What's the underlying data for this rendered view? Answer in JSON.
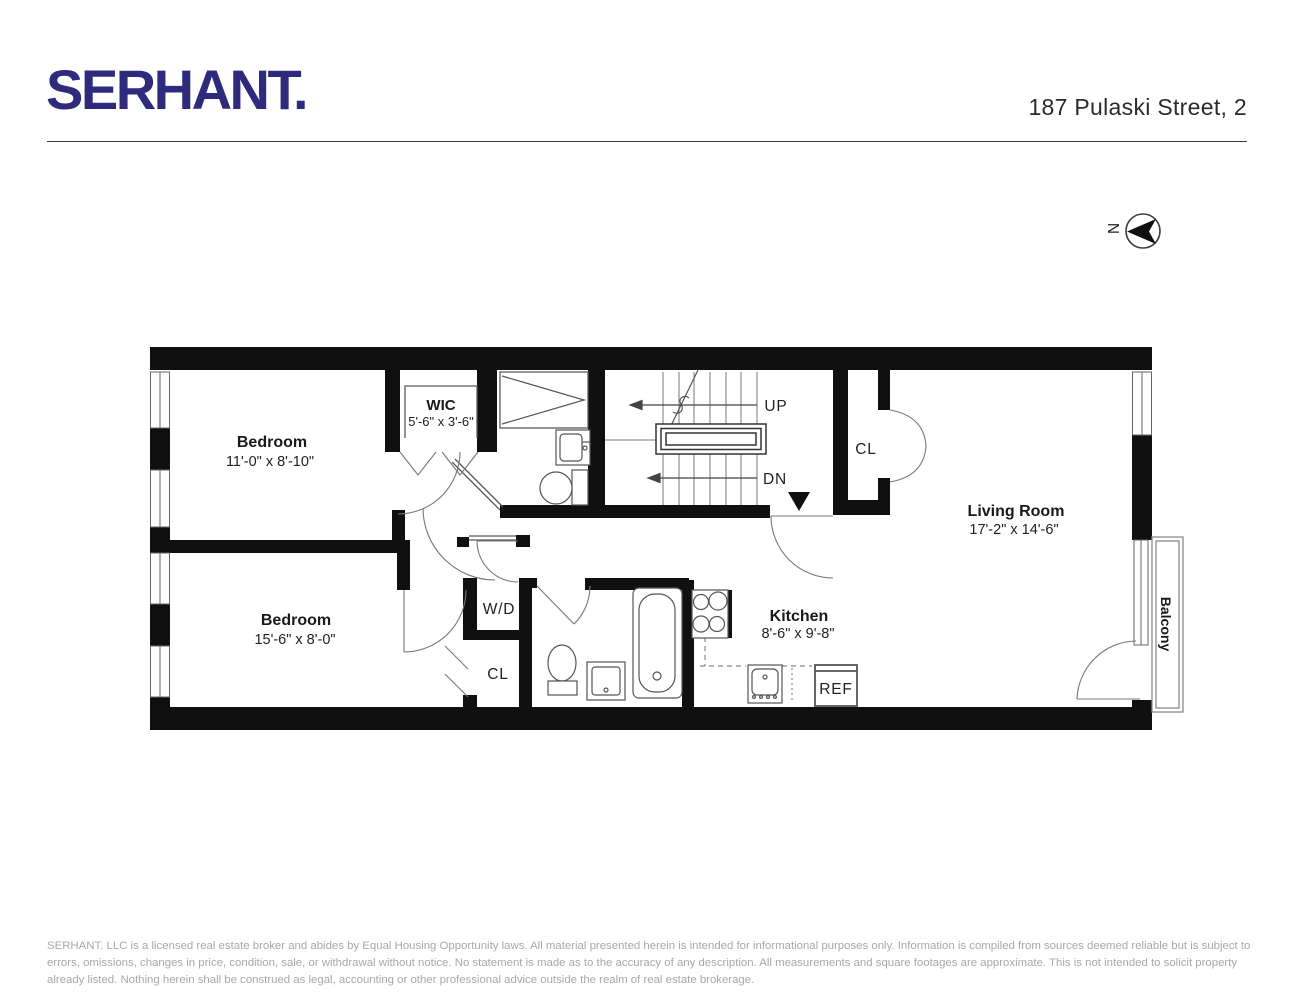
{
  "header": {
    "logo": "SERHANT.",
    "address": "187 Pulaski Street, 2"
  },
  "compass": {
    "north_label": "N"
  },
  "floorplan": {
    "rooms": {
      "bedroom1": {
        "name": "Bedroom",
        "dims": "11'-0\" x 8'-10\""
      },
      "wic": {
        "name": "WIC",
        "dims": "5'-6\" x 3'-6\""
      },
      "bedroom2": {
        "name": "Bedroom",
        "dims": "15'-6\" x 8'-0\""
      },
      "kitchen": {
        "name": "Kitchen",
        "dims": "8'-6\" x 9'-8\""
      },
      "living_room": {
        "name": "Living Room",
        "dims": "17'-2\" x 14'-6\""
      },
      "balcony": {
        "name": "Balcony"
      },
      "closet_hall": {
        "name": "CL"
      },
      "closet_lower": {
        "name": "CL"
      },
      "washer_dryer": {
        "name": "W/D"
      },
      "refrigerator": {
        "name": "REF"
      }
    },
    "stairs": {
      "up": "UP",
      "down": "DN"
    }
  },
  "footer": {
    "disclaimer": "SERHANT. LLC is a licensed real estate broker and abides by Equal Housing Opportunity laws. All material presented herein is intended for informational purposes only. Information is compiled from sources deemed  reliable but is subject to errors, omissions, changes in price, condition, sale, or withdrawal without notice. No statement is made as to the accuracy of any description. All measurements and square footages are approximate. This is not intended to solicit property already listed. Nothing herein shall be construed as legal, accounting or other professional advice outside the realm of real estate brokerage."
  },
  "colors": {
    "logo": "#2e2b7f",
    "walls": "#101010",
    "line": "#6b6b6b",
    "text": "#1a1a1a",
    "muted": "#a8a8a8"
  }
}
